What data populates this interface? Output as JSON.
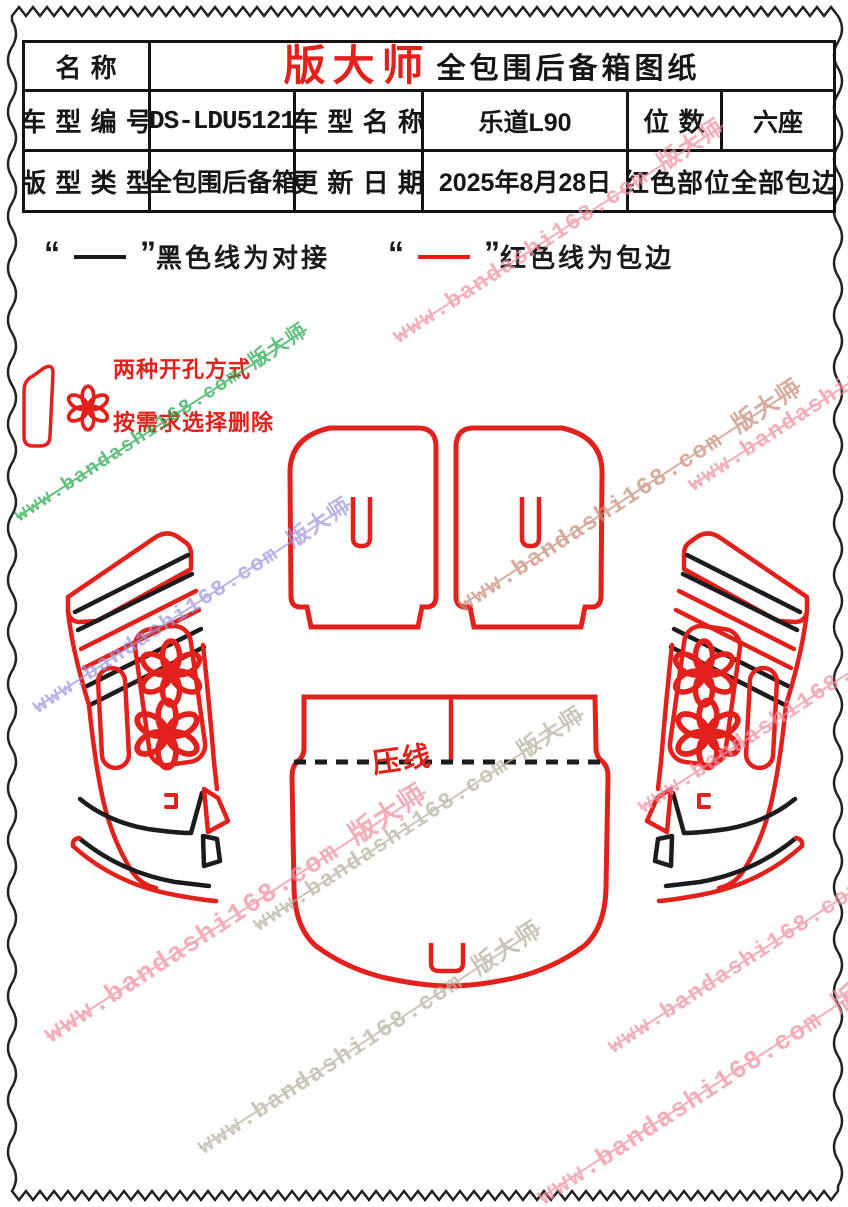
{
  "colors": {
    "line_red": "#e2201c",
    "line_black": "#1c1c1c",
    "brand_red": "#e2201c",
    "table_border": "#131313",
    "watermark_pink": "#ef8fa0",
    "watermark_green": "#27a94e",
    "watermark_blue": "#9b97dd",
    "watermark_gray": "#b7b2a0",
    "watermark_brown": "#c98d7b"
  },
  "table": {
    "row1": {
      "name_label": "名 称",
      "brand": "版大师",
      "title": "全包围后备箱图纸"
    },
    "row2": {
      "model_code_label": "车 型 编 号",
      "model_code": "BDS-LDU5121W",
      "model_name_label": "车 型 名 称",
      "model_name": "乐道L90",
      "seats_label": "位 数",
      "seats": "六座"
    },
    "row3": {
      "pattern_type_label": "版 型 类 型",
      "pattern_type": "全包围后备箱",
      "update_date_label": "更 新 日 期",
      "update_date": "2025年8月28日",
      "note": "红色部位全部包边"
    }
  },
  "legend": {
    "quote_open": "“",
    "quote_close": "”",
    "black_line_label": "黑色线为对接",
    "red_line_label": "红色线为包边"
  },
  "annotations": {
    "hole_note_line1": "两种开孔方式",
    "hole_note_line2": "按需求选择删除",
    "press_line_label": "压线"
  },
  "watermark": {
    "text": "www.bandashi168.com 版大师",
    "items": [
      {
        "x": 393,
        "y": 318,
        "color": "#ef8fa0",
        "size": 23
      },
      {
        "x": 15,
        "y": 500,
        "color": "#27a94e",
        "size": 20
      },
      {
        "x": 688,
        "y": 466,
        "color": "#ef8fa0",
        "size": 23
      },
      {
        "x": 458,
        "y": 586,
        "color": "#c98d7b",
        "size": 24
      },
      {
        "x": 33,
        "y": 690,
        "color": "#9b97dd",
        "size": 22
      },
      {
        "x": 638,
        "y": 788,
        "color": "#ef8fa0",
        "size": 23
      },
      {
        "x": 253,
        "y": 906,
        "color": "#b7b2a0",
        "size": 23
      },
      {
        "x": 45,
        "y": 1014,
        "color": "#ef8fa0",
        "size": 27
      },
      {
        "x": 198,
        "y": 1128,
        "color": "#b7b2a0",
        "size": 24
      },
      {
        "x": 538,
        "y": 1178,
        "color": "#ef8fa0",
        "size": 26
      },
      {
        "x": 608,
        "y": 1028,
        "color": "#ef8fa0",
        "size": 23
      }
    ]
  }
}
